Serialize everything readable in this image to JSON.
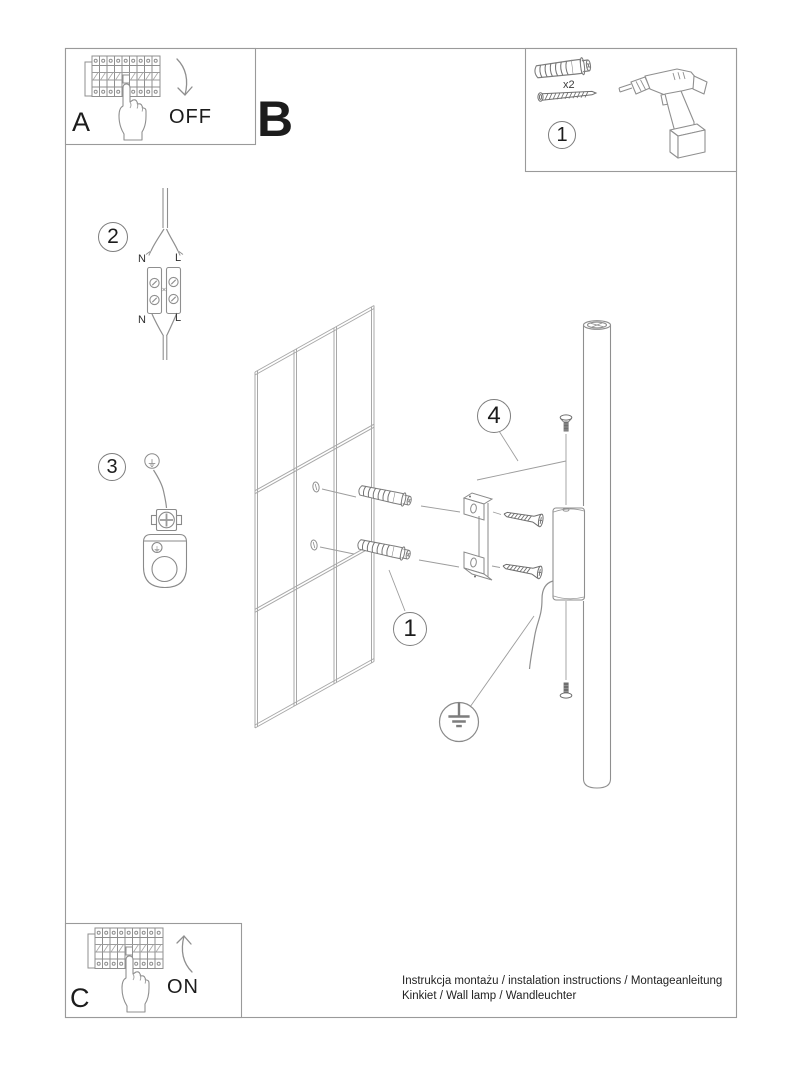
{
  "frame_letters": {
    "a": "A",
    "b": "B",
    "c": "C"
  },
  "switch_labels": {
    "off": "OFF",
    "on": "ON"
  },
  "step_numbers": {
    "parts_box": "1",
    "wiring": "2",
    "grounding": "3",
    "anchors_callout": "1",
    "final_mount": "4"
  },
  "wiring_labels": {
    "n_top": "N",
    "l_top": "L",
    "n_bottom": "N",
    "l_bottom": "L"
  },
  "parts": {
    "anchor_quantity": "x2"
  },
  "footer": {
    "line1": "Instrukcja montażu / instalation instructions / Montageanleitung",
    "line2": "Kinkiet / Wall lamp / Wandleuchter"
  },
  "colors": {
    "frame_line": "#9a9a9a",
    "drawing_line": "#8f8f8f",
    "light_line": "#a8a8a8",
    "dark_part": "#6f6f6f",
    "text": "#1c1c1c"
  }
}
